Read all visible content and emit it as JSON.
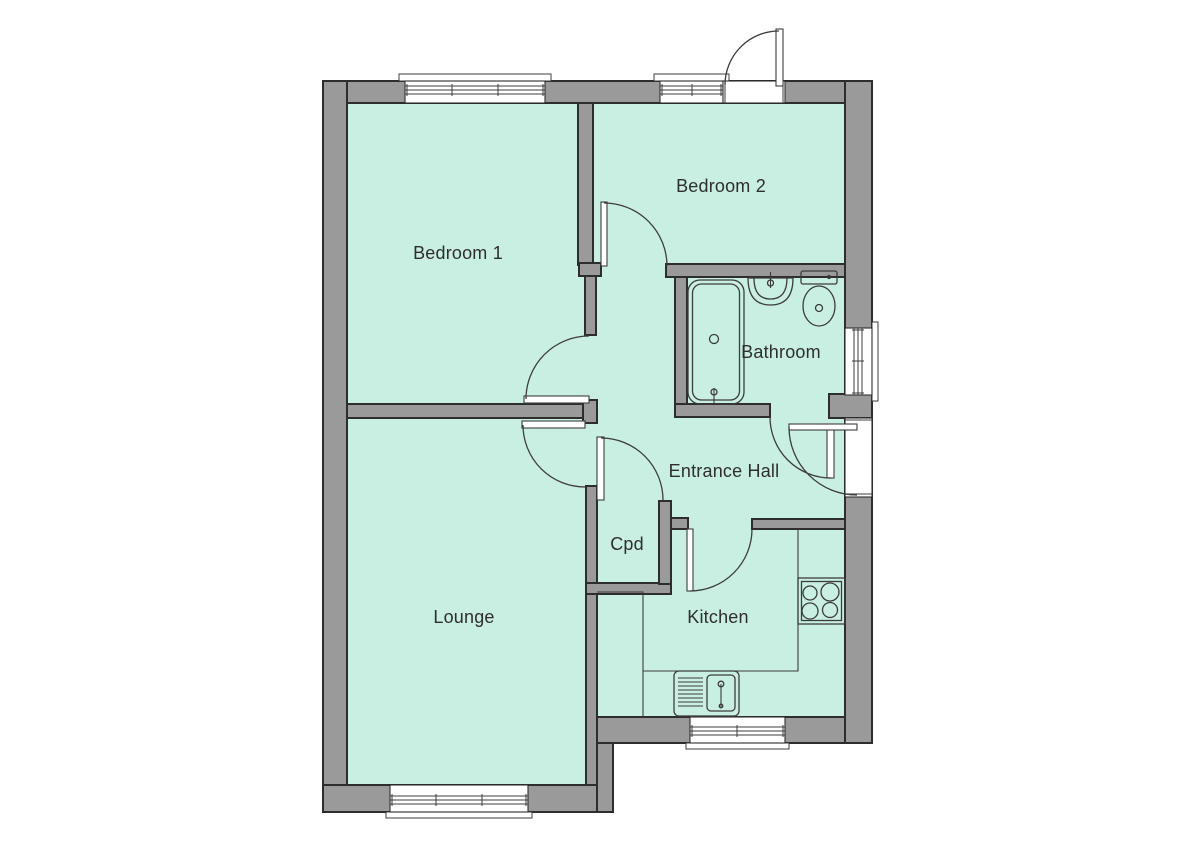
{
  "document": {
    "type": "floor-plan"
  },
  "colors": {
    "background": "#ffffff",
    "floor": "#c9efe2",
    "wall": "#9a9a9a",
    "outline": "#2d2d2d",
    "line": "#3c3c3c",
    "text": "#2e2e2e"
  },
  "rooms": {
    "bedroom1": {
      "label": "Bedroom 1"
    },
    "bedroom2": {
      "label": "Bedroom 2"
    },
    "bathroom": {
      "label": "Bathroom"
    },
    "entrance_hall": {
      "label": "Entrance Hall"
    },
    "cupboard": {
      "label": "Cpd"
    },
    "lounge": {
      "label": "Lounge"
    },
    "kitchen": {
      "label": "Kitchen"
    }
  },
  "fixtures": {
    "bathroom": [
      "bathtub",
      "wash-basin",
      "toilet"
    ],
    "kitchen": [
      "hob",
      "sink-with-drainer",
      "worktop"
    ]
  },
  "openings": {
    "windows": 5,
    "door_swings": 8
  }
}
